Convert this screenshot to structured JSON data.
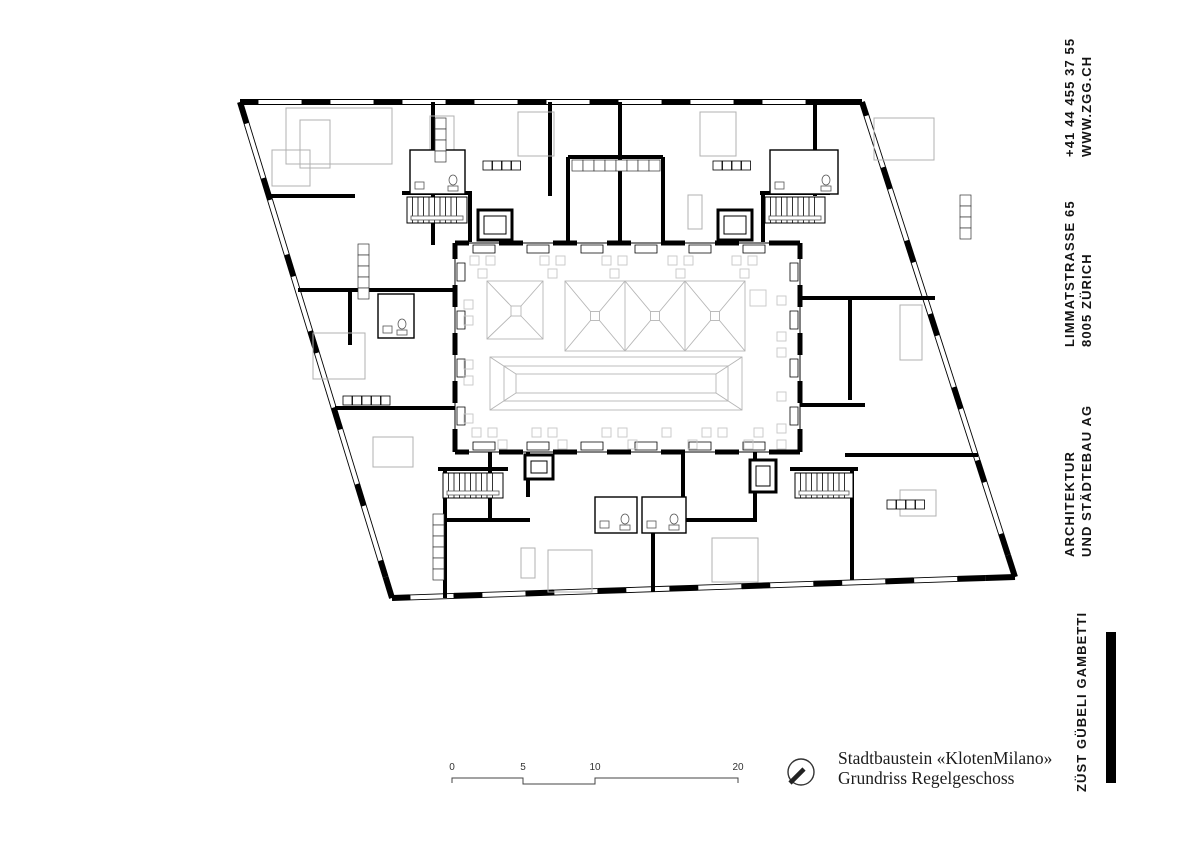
{
  "page": {
    "background": "#ffffff"
  },
  "sidebar": {
    "contact": {
      "line1": "+41 44 455 37 55",
      "line2": "WWW.ZGG.CH"
    },
    "address": {
      "line1": "LIMMATSTRASSE 65",
      "line2": "8005 ZÜRICH"
    },
    "firm_type": {
      "line1": "ARCHITEKTUR",
      "line2": "UND STÄDTEBAU AG"
    },
    "firm_name": "ZÜST GÜBELI GAMBETTI"
  },
  "title_block": {
    "line1": "Stadtbaustein «KlotenMilano»",
    "line2": "Grundriss Regelgeschoss"
  },
  "scale_bar": {
    "labels": [
      "0",
      "5",
      "10",
      "20"
    ]
  },
  "icons": {
    "north_arrow": "north-arrow-icon"
  },
  "colors": {
    "wall": "#000000",
    "furniture": "#b0b0b0",
    "courtyard_items": "#c6c6c6",
    "skylight": "#b5b5b5",
    "linework": "#444444"
  },
  "plan": {
    "edges": [
      {
        "from": [
          240,
          102
        ],
        "to": [
          862,
          102
        ],
        "lead": 18,
        "win": 44,
        "wall": 28,
        "t": 6
      },
      {
        "from": [
          392,
          598
        ],
        "to": [
          1015,
          577
        ],
        "lead": 18,
        "win": 44,
        "wall": 28,
        "t": 6
      },
      {
        "from": [
          240,
          102
        ],
        "to": [
          392,
          598
        ],
        "lead": 22,
        "win": 58,
        "wall": 22,
        "t": 6
      },
      {
        "from": [
          862,
          102
        ],
        "to": [
          1015,
          577
        ],
        "lead": 14,
        "win": 55,
        "wall": 22,
        "t": 6
      },
      {
        "from": [
          455,
          243
        ],
        "to": [
          800,
          243
        ],
        "lead": 14,
        "win": 30,
        "wall": 24,
        "t": 5,
        "box": 1
      },
      {
        "from": [
          455,
          452
        ],
        "to": [
          800,
          452
        ],
        "lead": 14,
        "win": 30,
        "wall": 24,
        "t": 5,
        "box": -1
      },
      {
        "from": [
          455,
          243
        ],
        "to": [
          455,
          452
        ],
        "lead": 16,
        "win": 26,
        "wall": 22,
        "t": 5,
        "box": -1
      },
      {
        "from": [
          800,
          243
        ],
        "to": [
          800,
          452
        ],
        "lead": 16,
        "win": 26,
        "wall": 22,
        "t": 5,
        "box": 1
      }
    ],
    "walls": [
      [
        433,
        102,
        433,
        245
      ],
      [
        620,
        102,
        620,
        245
      ],
      [
        550,
        102,
        550,
        196
      ],
      [
        815,
        102,
        815,
        196
      ],
      [
        568,
        157,
        663,
        157
      ],
      [
        568,
        157,
        568,
        245
      ],
      [
        663,
        157,
        663,
        245
      ],
      [
        268,
        196,
        355,
        196
      ],
      [
        298,
        290,
        455,
        290
      ],
      [
        350,
        290,
        350,
        345
      ],
      [
        335,
        408,
        455,
        408
      ],
      [
        800,
        298,
        935,
        298
      ],
      [
        850,
        298,
        850,
        400
      ],
      [
        800,
        405,
        865,
        405
      ],
      [
        845,
        455,
        978,
        455
      ],
      [
        445,
        470,
        445,
        598
      ],
      [
        490,
        452,
        490,
        520
      ],
      [
        528,
        452,
        528,
        497
      ],
      [
        653,
        530,
        653,
        592
      ],
      [
        683,
        452,
        683,
        530
      ],
      [
        755,
        452,
        755,
        522
      ],
      [
        852,
        470,
        852,
        580
      ],
      [
        445,
        520,
        530,
        520
      ],
      [
        683,
        520,
        757,
        520
      ],
      [
        470,
        192,
        470,
        242
      ],
      [
        763,
        192,
        763,
        242
      ]
    ],
    "stairs": [
      [
        407,
        197,
        60,
        26
      ],
      [
        765,
        197,
        60,
        26
      ],
      [
        443,
        473,
        60,
        25
      ],
      [
        795,
        473,
        58,
        25
      ]
    ],
    "elevators": [
      [
        478,
        210,
        34,
        30
      ],
      [
        718,
        210,
        34,
        30
      ],
      [
        525,
        455,
        28,
        24
      ],
      [
        750,
        460,
        26,
        32
      ]
    ],
    "bathrooms": [
      [
        410,
        150,
        55,
        44
      ],
      [
        770,
        150,
        68,
        44
      ],
      [
        595,
        497,
        42,
        36
      ],
      [
        642,
        497,
        44,
        36
      ],
      [
        378,
        294,
        36,
        44
      ]
    ],
    "kitchens": [
      [
        483,
        161,
        4
      ],
      [
        713,
        161,
        4
      ],
      [
        343,
        396,
        5
      ],
      [
        887,
        500,
        4
      ]
    ],
    "wardrobes": [
      [
        572,
        160,
        8,
        "h"
      ],
      [
        433,
        514,
        6,
        "v"
      ],
      [
        358,
        244,
        5,
        "v"
      ],
      [
        435,
        118,
        4,
        "v"
      ],
      [
        960,
        195,
        4,
        "v"
      ]
    ],
    "gray_rects": [
      [
        300,
        120,
        30,
        48
      ],
      [
        430,
        116,
        24,
        52
      ],
      [
        286,
        108,
        106,
        56
      ],
      [
        518,
        112,
        36,
        44
      ],
      [
        700,
        112,
        36,
        44
      ],
      [
        874,
        118,
        60,
        42
      ],
      [
        900,
        305,
        22,
        55
      ],
      [
        313,
        333,
        52,
        46
      ],
      [
        373,
        437,
        40,
        30
      ],
      [
        548,
        550,
        44,
        42
      ],
      [
        712,
        538,
        46,
        44
      ],
      [
        521,
        548,
        14,
        30
      ],
      [
        272,
        150,
        38,
        36
      ],
      [
        688,
        195,
        14,
        34
      ],
      [
        900,
        490,
        36,
        26
      ]
    ],
    "small_squares": [
      [
        470,
        256
      ],
      [
        486,
        256
      ],
      [
        540,
        256
      ],
      [
        556,
        256
      ],
      [
        602,
        256
      ],
      [
        618,
        256
      ],
      [
        668,
        256
      ],
      [
        684,
        256
      ],
      [
        732,
        256
      ],
      [
        748,
        256
      ],
      [
        478,
        269
      ],
      [
        548,
        269
      ],
      [
        610,
        269
      ],
      [
        676,
        269
      ],
      [
        740,
        269
      ],
      [
        464,
        300
      ],
      [
        464,
        316
      ],
      [
        464,
        360
      ],
      [
        464,
        376
      ],
      [
        464,
        414
      ],
      [
        777,
        296
      ],
      [
        777,
        332
      ],
      [
        777,
        348
      ],
      [
        777,
        392
      ],
      [
        777,
        424
      ],
      [
        777,
        440
      ],
      [
        472,
        428
      ],
      [
        488,
        428
      ],
      [
        532,
        428
      ],
      [
        548,
        428
      ],
      [
        602,
        428
      ],
      [
        618,
        428
      ],
      [
        662,
        428
      ],
      [
        702,
        428
      ],
      [
        718,
        428
      ],
      [
        754,
        428
      ],
      [
        498,
        440
      ],
      [
        558,
        440
      ],
      [
        628,
        440
      ],
      [
        688,
        440
      ],
      [
        744,
        440
      ],
      [
        750,
        290,
        16
      ]
    ],
    "skylights": {
      "sq": {
        "r": [
          487,
          281,
          56,
          58
        ],
        "c": [
          511,
          306,
          10,
          10
        ]
      },
      "triple": {
        "r": [
          565,
          281,
          180,
          70
        ],
        "splits": [
          625,
          685
        ],
        "cy": 316,
        "cs": 9
      },
      "ridge": {
        "outer": [
          490,
          357,
          252,
          53
        ],
        "mid": [
          504,
          366,
          224,
          35
        ],
        "inner": [
          516,
          374,
          200,
          19
        ]
      }
    },
    "scale_bar_path": "452,783 452,778 523,778 523,784 595,784 595,778 738,778 738,783",
    "north": {
      "cx": 801,
      "cy": 772,
      "r": 13
    }
  }
}
